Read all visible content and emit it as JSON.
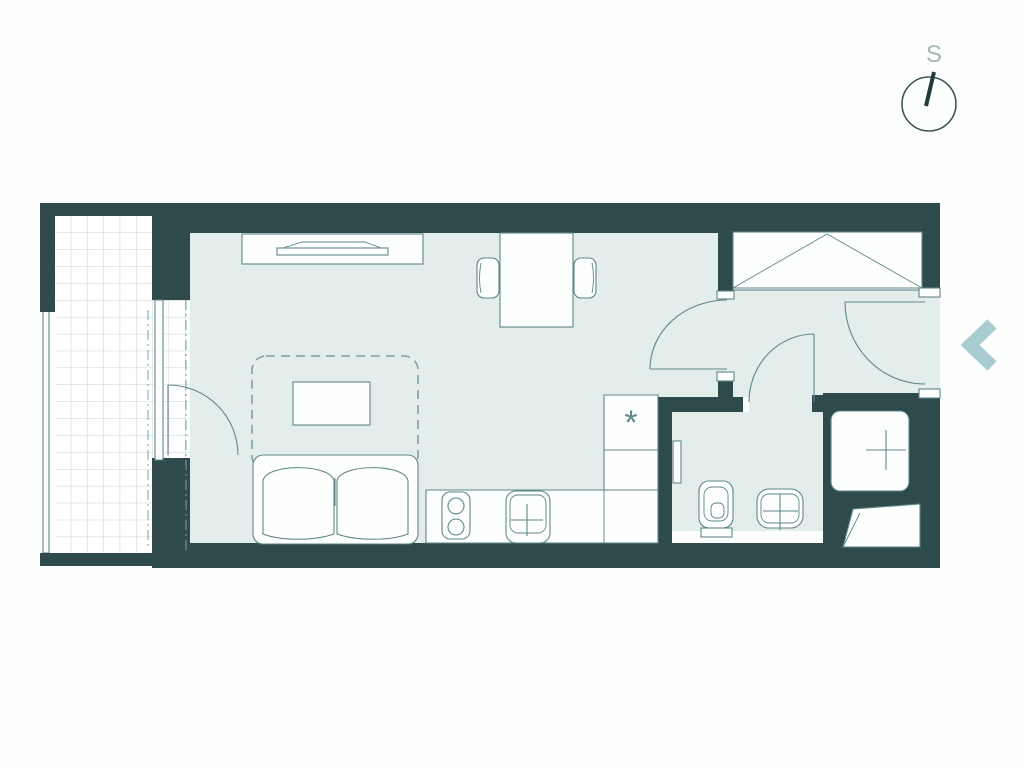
{
  "theme": {
    "page_bg": "#fdfefe",
    "wall": "#2f4a4a",
    "floor": "#e3edeb",
    "fill": "#fcfffe",
    "line": "#5f8688",
    "grid": "#c6d5d3",
    "dash": "#7fa0a0",
    "chevron": "#a9cbd2",
    "compass": "#3c5857",
    "needle": "#223b3a",
    "muted": "#a3b6b6"
  },
  "compass": {
    "label": "S",
    "icon": "compass-icon"
  },
  "kitchen": {
    "appliance_marker": "*"
  },
  "nav": {
    "previous": {
      "icon": "chevron-left-icon",
      "label": ""
    }
  },
  "plan": {
    "type": "studio-apartment-floor-plan",
    "areas": [
      "balcony",
      "living-room",
      "kitchen",
      "hallway",
      "bathroom",
      "wardrobe-niche",
      "shower-niche"
    ],
    "furniture": [
      "sideboard",
      "tv",
      "dining-table",
      "chairs",
      "sofa-bed",
      "bed-outline",
      "coffee-table",
      "cooktop",
      "kitchen-sink",
      "toilet",
      "washbasin",
      "shower",
      "installation-shaft"
    ]
  }
}
